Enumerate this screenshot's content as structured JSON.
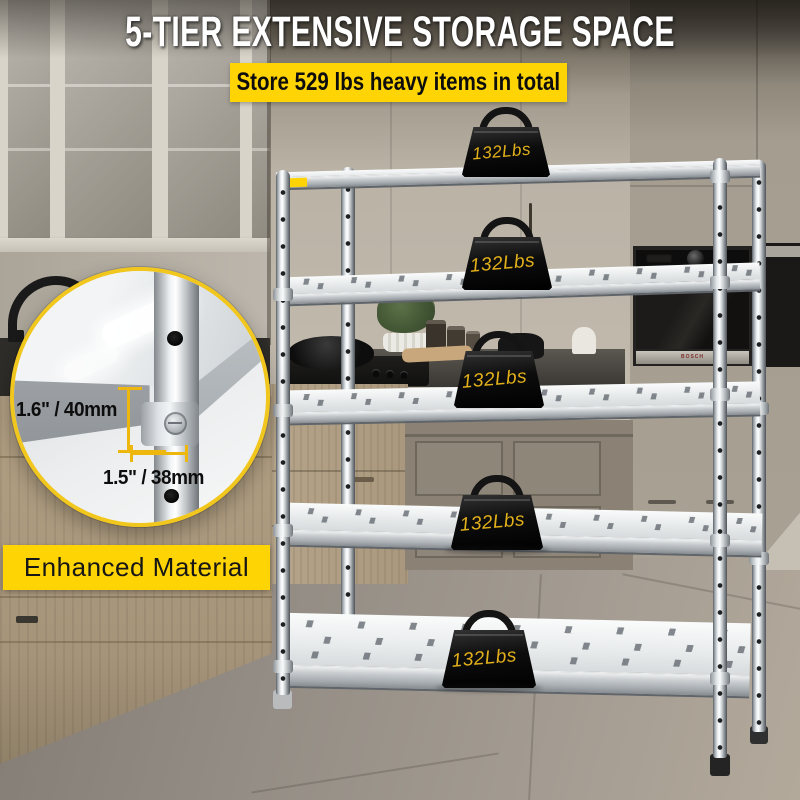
{
  "header": {
    "title": "5-TIER EXTENSIVE STORAGE SPACE",
    "banner": "Store 529 lbs heavy items in total"
  },
  "shelf_unit": {
    "tiers": 5,
    "weight_labels": [
      "132Lbs",
      "132Lbs",
      "132Lbs",
      "132Lbs",
      "132Lbs"
    ]
  },
  "callout": {
    "vertical_measure": "1.6\" / 40mm",
    "horizontal_measure": "1.5\" / 38mm"
  },
  "badge": "Enhanced Material",
  "appliance_brand": "BOSCH",
  "colors": {
    "accent_yellow": "#FFD404",
    "weight_label_yellow": "#E2B01A",
    "dimension_yellow": "#EDB70E",
    "headline_white": "#FFFFFF",
    "text_black": "#111111"
  }
}
